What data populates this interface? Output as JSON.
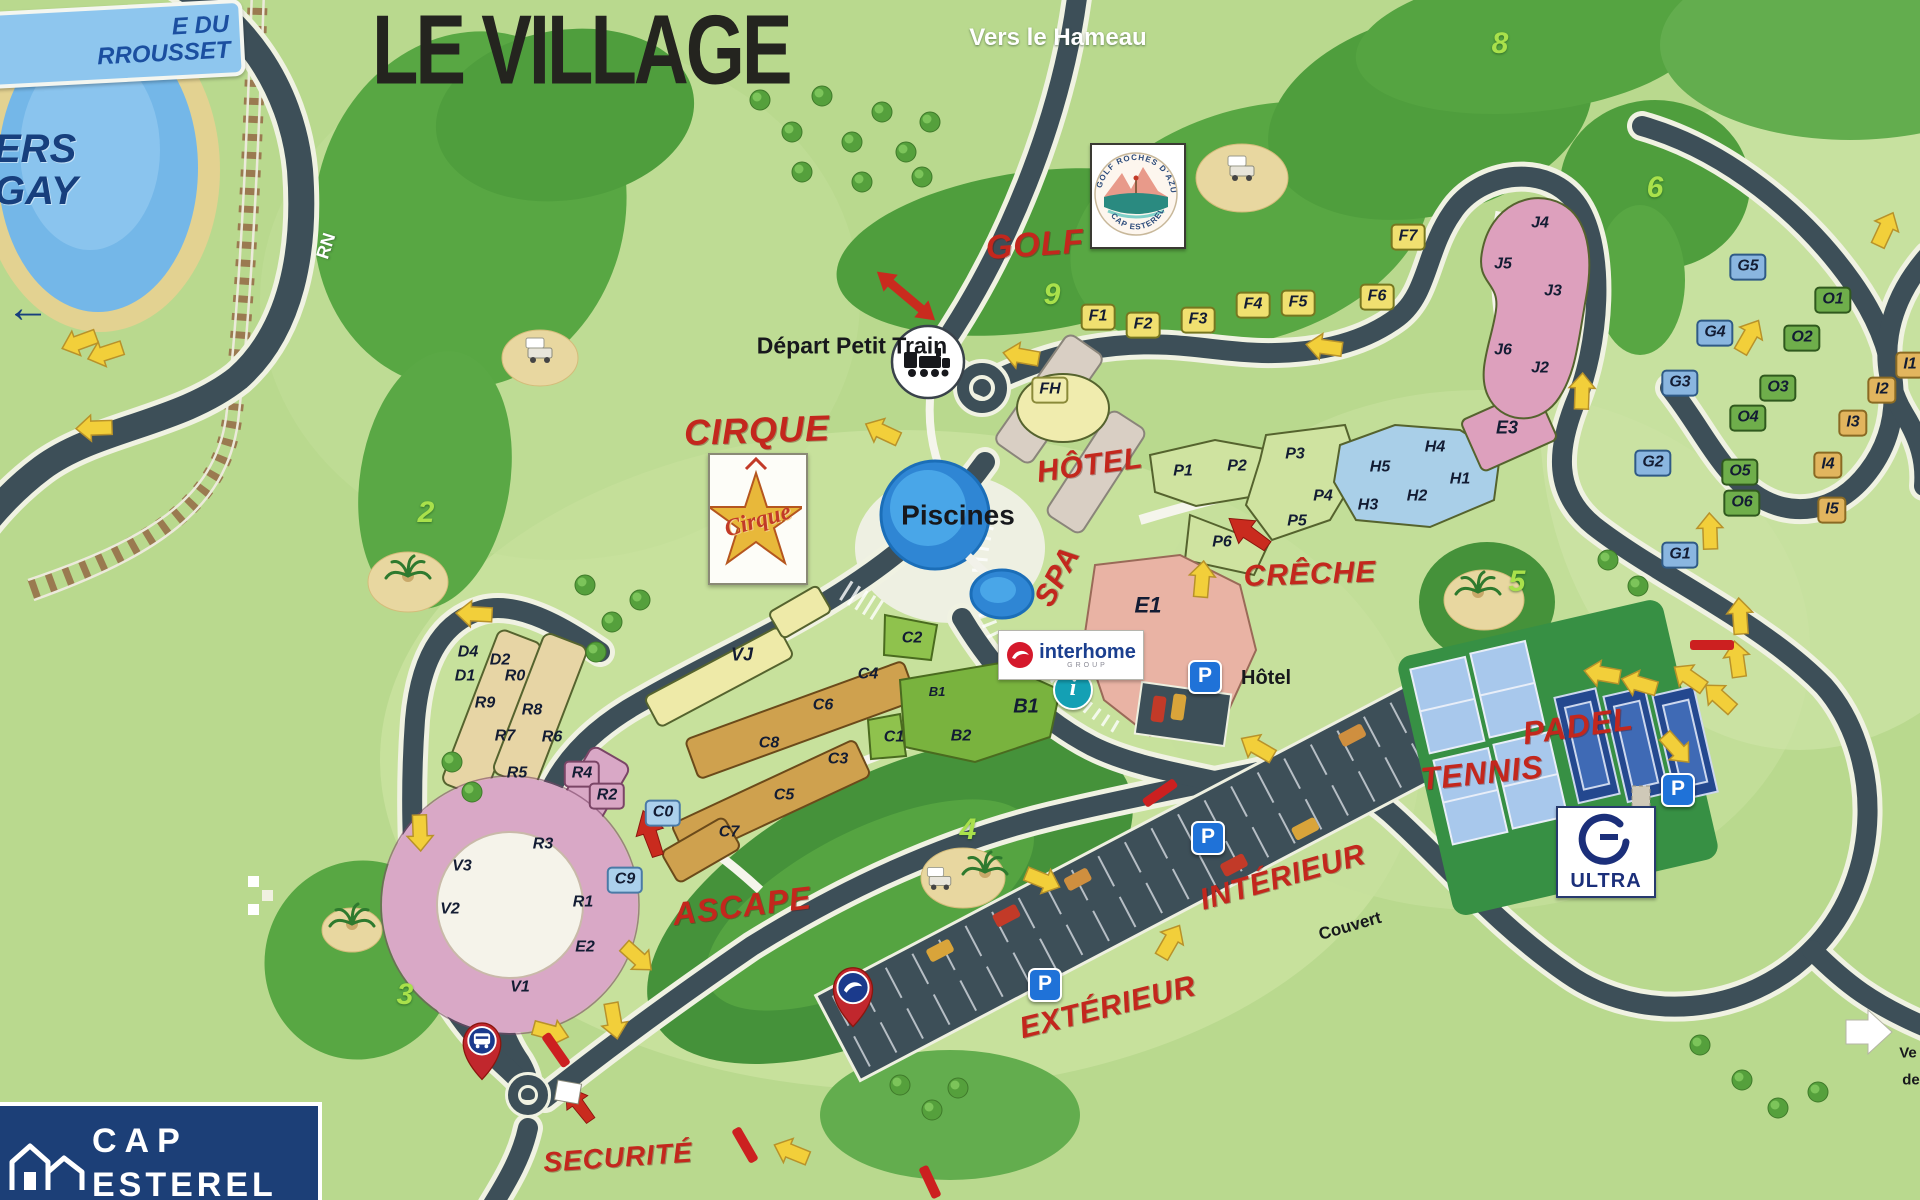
{
  "title": {
    "text": "LE VILLAGE"
  },
  "signs": {
    "plage": "E DU\nRROUSSET",
    "agay": "ERS\nGAY",
    "agay_arrow": "←",
    "rn": "RN"
  },
  "poi": [
    {
      "text": "GOLF",
      "x": 1035,
      "y": 245,
      "s": 34,
      "rot": -4,
      "cls": "p-red"
    },
    {
      "text": "CIRQUE",
      "x": 757,
      "y": 431,
      "s": 36,
      "rot": -2,
      "cls": "p-red"
    },
    {
      "text": "HÔTEL",
      "x": 1090,
      "y": 466,
      "s": 30,
      "rot": -8,
      "cls": "p-red"
    },
    {
      "text": "SPA",
      "x": 1058,
      "y": 577,
      "s": 30,
      "rot": -62,
      "cls": "p-red"
    },
    {
      "text": "CRÊCHE",
      "x": 1310,
      "y": 575,
      "s": 30,
      "rot": -2,
      "cls": "p-red"
    },
    {
      "text": "ASCAPE",
      "x": 742,
      "y": 906,
      "s": 32,
      "rot": -7,
      "cls": "p-red"
    },
    {
      "text": "TENNIS",
      "x": 1482,
      "y": 773,
      "s": 32,
      "rot": -6,
      "cls": "p-red"
    },
    {
      "text": "PADEL",
      "x": 1578,
      "y": 726,
      "s": 32,
      "rot": -8,
      "cls": "p-red"
    },
    {
      "text": "INTÉRIEUR",
      "x": 1283,
      "y": 878,
      "s": 30,
      "rot": -16,
      "cls": "p-red"
    },
    {
      "text": "EXTÉRIEUR",
      "x": 1108,
      "y": 1008,
      "s": 30,
      "rot": -14,
      "cls": "p-red"
    },
    {
      "text": "SECURITÉ",
      "x": 618,
      "y": 1158,
      "s": 28,
      "rot": -4,
      "cls": "p-red"
    },
    {
      "text": "Piscines",
      "x": 958,
      "y": 516,
      "s": 28,
      "cls": "p-black"
    },
    {
      "text": "Hôtel",
      "x": 1266,
      "y": 678,
      "s": 20,
      "cls": "p-black"
    },
    {
      "text": "Couvert",
      "x": 1350,
      "y": 926,
      "s": 17,
      "rot": -16,
      "cls": "p-black"
    },
    {
      "text": "Vers le\nHameau",
      "x": 1058,
      "y": 38,
      "s": 24,
      "cls": "p-white"
    },
    {
      "text": "Départ\nPetit\nTrain",
      "x": 852,
      "y": 346,
      "s": 23,
      "cls": "p-black",
      "align": "right"
    },
    {
      "text": "RN",
      "x": 326,
      "y": 246,
      "s": 18,
      "rot": -72,
      "cls": "p-white"
    },
    {
      "text": "Ve",
      "x": 1908,
      "y": 1053,
      "s": 15,
      "cls": "p-black"
    },
    {
      "text": "de",
      "x": 1911,
      "y": 1080,
      "s": 15,
      "cls": "p-black"
    }
  ],
  "buildings": [
    {
      "t": "F1",
      "x": 1098,
      "y": 317,
      "c": "yellow",
      "b": 1
    },
    {
      "t": "F2",
      "x": 1143,
      "y": 325,
      "c": "yellow",
      "b": 1
    },
    {
      "t": "F3",
      "x": 1198,
      "y": 320,
      "c": "yellow",
      "b": 1
    },
    {
      "t": "F4",
      "x": 1253,
      "y": 305,
      "c": "yellow",
      "b": 1
    },
    {
      "t": "F5",
      "x": 1298,
      "y": 303,
      "c": "yellow",
      "b": 1
    },
    {
      "t": "F6",
      "x": 1377,
      "y": 297,
      "c": "yellow",
      "b": 1
    },
    {
      "t": "F7",
      "x": 1408,
      "y": 237,
      "c": "yellow",
      "b": 1
    },
    {
      "t": "FH",
      "x": 1050,
      "y": 390,
      "c": "paleyellow",
      "b": 1
    },
    {
      "t": "P1",
      "x": 1183,
      "y": 472,
      "c": "bare"
    },
    {
      "t": "P2",
      "x": 1237,
      "y": 467,
      "c": "bare"
    },
    {
      "t": "P3",
      "x": 1295,
      "y": 455,
      "c": "bare"
    },
    {
      "t": "P4",
      "x": 1323,
      "y": 497,
      "c": "bare"
    },
    {
      "t": "P5",
      "x": 1297,
      "y": 522,
      "c": "bare"
    },
    {
      "t": "P6",
      "x": 1222,
      "y": 543,
      "c": "bare"
    },
    {
      "t": "H5",
      "x": 1380,
      "y": 468,
      "c": "bare"
    },
    {
      "t": "H4",
      "x": 1435,
      "y": 448,
      "c": "bare"
    },
    {
      "t": "H3",
      "x": 1368,
      "y": 506,
      "c": "bare"
    },
    {
      "t": "H2",
      "x": 1417,
      "y": 497,
      "c": "bare"
    },
    {
      "t": "H1",
      "x": 1460,
      "y": 480,
      "c": "bare"
    },
    {
      "t": "E3",
      "x": 1507,
      "y": 428,
      "c": "bare",
      "s": 18
    },
    {
      "t": "J4",
      "x": 1540,
      "y": 224,
      "c": "bare"
    },
    {
      "t": "J5",
      "x": 1503,
      "y": 265,
      "c": "bare"
    },
    {
      "t": "J3",
      "x": 1553,
      "y": 292,
      "c": "bare"
    },
    {
      "t": "J6",
      "x": 1503,
      "y": 351,
      "c": "bare"
    },
    {
      "t": "J2",
      "x": 1540,
      "y": 369,
      "c": "bare"
    },
    {
      "t": "G5",
      "x": 1748,
      "y": 267,
      "c": "gblue",
      "b": 1
    },
    {
      "t": "G4",
      "x": 1715,
      "y": 333,
      "c": "gblue",
      "b": 1
    },
    {
      "t": "G3",
      "x": 1680,
      "y": 383,
      "c": "gblue",
      "b": 1
    },
    {
      "t": "G2",
      "x": 1653,
      "y": 463,
      "c": "gblue",
      "b": 1
    },
    {
      "t": "G1",
      "x": 1680,
      "y": 555,
      "c": "gblue",
      "b": 1
    },
    {
      "t": "O1",
      "x": 1833,
      "y": 300,
      "c": "ogreen",
      "b": 1
    },
    {
      "t": "O2",
      "x": 1802,
      "y": 338,
      "c": "ogreen",
      "b": 1
    },
    {
      "t": "O3",
      "x": 1778,
      "y": 388,
      "c": "ogreen",
      "b": 1
    },
    {
      "t": "O4",
      "x": 1748,
      "y": 418,
      "c": "ogreen",
      "b": 1
    },
    {
      "t": "O5",
      "x": 1740,
      "y": 472,
      "c": "ogreen",
      "b": 1
    },
    {
      "t": "O6",
      "x": 1742,
      "y": 503,
      "c": "ogreen",
      "b": 1
    },
    {
      "t": "I1",
      "x": 1910,
      "y": 365,
      "c": "itan",
      "b": 1
    },
    {
      "t": "I2",
      "x": 1882,
      "y": 390,
      "c": "itan",
      "b": 1
    },
    {
      "t": "I3",
      "x": 1853,
      "y": 423,
      "c": "itan",
      "b": 1
    },
    {
      "t": "I4",
      "x": 1828,
      "y": 465,
      "c": "itan",
      "b": 1
    },
    {
      "t": "I5",
      "x": 1832,
      "y": 510,
      "c": "itan",
      "b": 1
    },
    {
      "t": "D4",
      "x": 468,
      "y": 653,
      "c": "bare"
    },
    {
      "t": "D2",
      "x": 500,
      "y": 661,
      "c": "bare"
    },
    {
      "t": "D1",
      "x": 465,
      "y": 677,
      "c": "bare"
    },
    {
      "t": "R0",
      "x": 515,
      "y": 677,
      "c": "bare"
    },
    {
      "t": "R9",
      "x": 485,
      "y": 704,
      "c": "bare"
    },
    {
      "t": "R8",
      "x": 532,
      "y": 711,
      "c": "bare"
    },
    {
      "t": "R7",
      "x": 505,
      "y": 737,
      "c": "bare"
    },
    {
      "t": "R6",
      "x": 552,
      "y": 738,
      "c": "bare"
    },
    {
      "t": "R5",
      "x": 517,
      "y": 774,
      "c": "bare"
    },
    {
      "t": "R4",
      "x": 582,
      "y": 774,
      "c": "pink",
      "b": 1
    },
    {
      "t": "R2",
      "x": 607,
      "y": 796,
      "c": "pink",
      "b": 1
    },
    {
      "t": "C0",
      "x": 663,
      "y": 813,
      "c": "lblue",
      "b": 1
    },
    {
      "t": "C9",
      "x": 625,
      "y": 880,
      "c": "lblue",
      "b": 1
    },
    {
      "t": "R3",
      "x": 543,
      "y": 845,
      "c": "bare"
    },
    {
      "t": "V3",
      "x": 462,
      "y": 867,
      "c": "bare"
    },
    {
      "t": "V2",
      "x": 450,
      "y": 910,
      "c": "bare"
    },
    {
      "t": "V1",
      "x": 520,
      "y": 988,
      "c": "bare"
    },
    {
      "t": "R1",
      "x": 583,
      "y": 903,
      "c": "bare"
    },
    {
      "t": "E2",
      "x": 585,
      "y": 948,
      "c": "bare"
    },
    {
      "t": "VJ",
      "x": 742,
      "y": 655,
      "c": "bare",
      "s": 18
    },
    {
      "t": "C4",
      "x": 868,
      "y": 675,
      "c": "bare"
    },
    {
      "t": "C6",
      "x": 823,
      "y": 706,
      "c": "bare"
    },
    {
      "t": "C8",
      "x": 769,
      "y": 744,
      "c": "bare"
    },
    {
      "t": "C3",
      "x": 838,
      "y": 760,
      "c": "bare"
    },
    {
      "t": "C5",
      "x": 784,
      "y": 796,
      "c": "bare"
    },
    {
      "t": "C7",
      "x": 729,
      "y": 833,
      "c": "bare"
    },
    {
      "t": "C2",
      "x": 912,
      "y": 639,
      "c": "bare"
    },
    {
      "t": "C1",
      "x": 894,
      "y": 738,
      "c": "bare"
    },
    {
      "t": "B2",
      "x": 961,
      "y": 737,
      "c": "bare"
    },
    {
      "t": "B1",
      "x": 1026,
      "y": 707,
      "c": "bare",
      "s": 20
    },
    {
      "t": "B1",
      "x": 937,
      "y": 692,
      "c": "bare",
      "s": 13
    },
    {
      "t": "E1",
      "x": 1148,
      "y": 605,
      "c": "bare",
      "s": 22
    }
  ],
  "golf_holes": [
    {
      "n": "9",
      "x": 1052,
      "y": 295
    },
    {
      "n": "8",
      "x": 1500,
      "y": 44
    },
    {
      "n": "6",
      "x": 1655,
      "y": 188
    },
    {
      "n": "5",
      "x": 1517,
      "y": 582
    },
    {
      "n": "4",
      "x": 968,
      "y": 830
    },
    {
      "n": "3",
      "x": 405,
      "y": 995
    },
    {
      "n": "2",
      "x": 426,
      "y": 513
    }
  ],
  "parking_icons": [
    {
      "p": "P",
      "x": 1205,
      "y": 677
    },
    {
      "p": "P",
      "x": 1678,
      "y": 790
    },
    {
      "p": "P",
      "x": 1208,
      "y": 838
    },
    {
      "p": "P",
      "x": 1045,
      "y": 985
    }
  ],
  "info_icon": {
    "glyph": "i"
  },
  "logos": {
    "interhome": {
      "name": "interhome",
      "sub": "GROUP"
    },
    "ultra": {
      "name": "ULTRA"
    },
    "golf_badge": {
      "arc_top": "GOLF ROCHES D'AZUR",
      "arc_bottom": "CAP ESTEREL"
    },
    "cirque": {
      "name": "Cirque"
    },
    "cap_esterel": {
      "line1": "CAP",
      "line2": "ESTEREL"
    }
  },
  "colors": {
    "grass": "#b9d98e",
    "dark_green": "#4f9e3d",
    "road": "#3d4f58",
    "water": "#5aaede",
    "accent_red": "#c3271d",
    "building_yellow": "#f0e070",
    "building_pink": "#d9a6c4",
    "building_blue": "#abd0ec",
    "parking_blue": "#1f72d8"
  }
}
